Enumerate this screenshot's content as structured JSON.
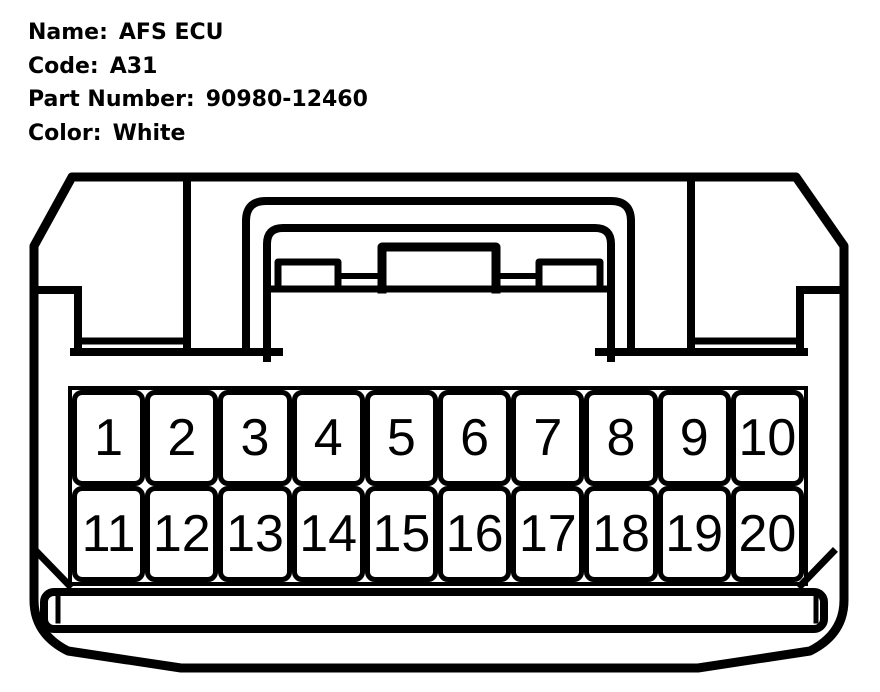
{
  "header": {
    "rows": [
      {
        "label": "Name:",
        "value": "AFS ECU"
      },
      {
        "label": "Code:",
        "value": "A31"
      },
      {
        "label": "Part Number:",
        "value": "90980-12460"
      },
      {
        "label": "Color:",
        "value": "White"
      }
    ]
  },
  "pins": {
    "row1": [
      "1",
      "2",
      "3",
      "4",
      "5",
      "6",
      "7",
      "8",
      "9",
      "10"
    ],
    "row2": [
      "11",
      "12",
      "13",
      "14",
      "15",
      "16",
      "17",
      "18",
      "19",
      "20"
    ]
  },
  "colors": {
    "line": "#000000",
    "background": "#ffffff"
  }
}
